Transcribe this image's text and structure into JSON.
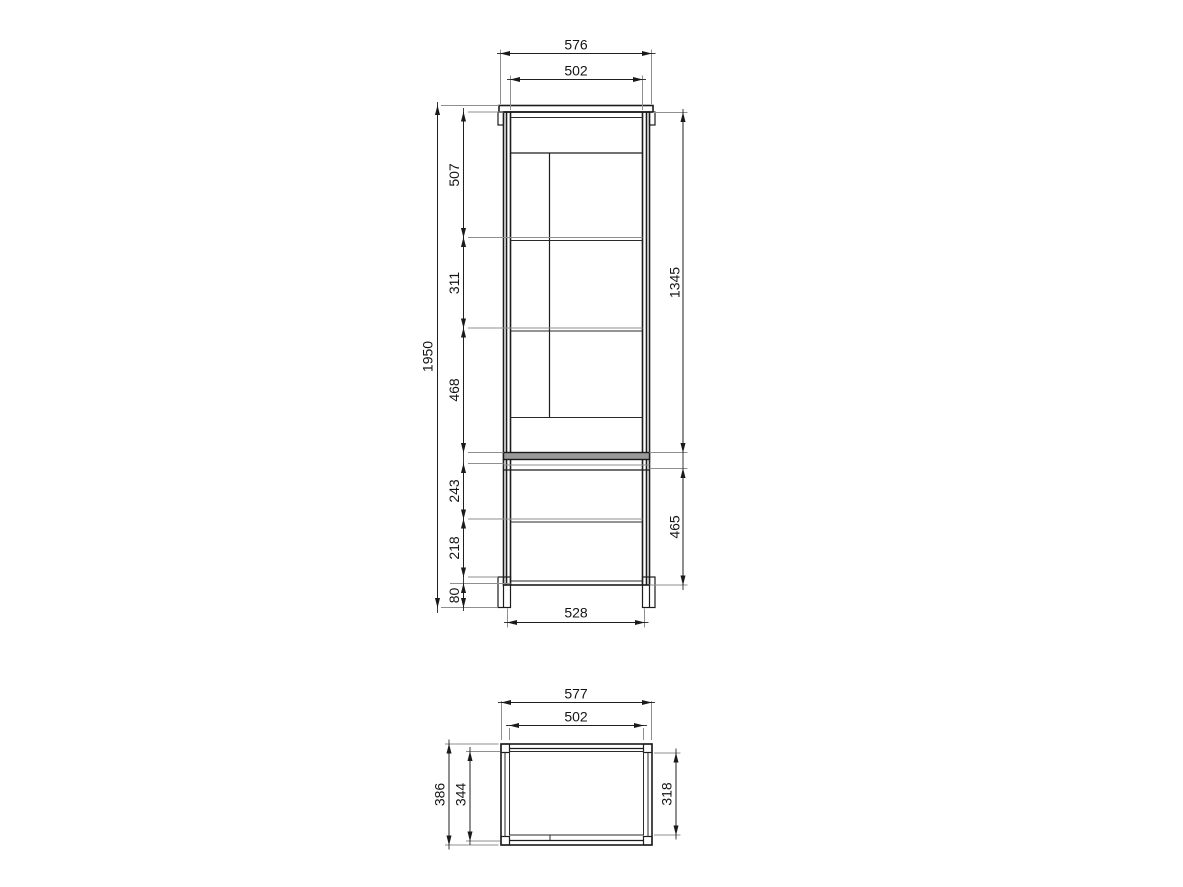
{
  "drawing_type": "furniture dimension drawing",
  "colors": {
    "background": "#ffffff",
    "line": "#1c1c1c",
    "extension_line": "#8f8f8f",
    "label": "#141414"
  },
  "front_view": {
    "top_width": "576",
    "inner_width": "502",
    "total_height": "1950",
    "left_segments": {
      "first": "507",
      "second": "311",
      "third": "468",
      "fourth": "243",
      "fifth": "218",
      "plinth": "80"
    },
    "upper_section_height": "1345",
    "lower_section_height": "465",
    "base_width": "528"
  },
  "top_view": {
    "total_width": "577",
    "inner_width": "502",
    "total_depth": "386",
    "mid_depth": "344",
    "inner_depth": "318"
  }
}
